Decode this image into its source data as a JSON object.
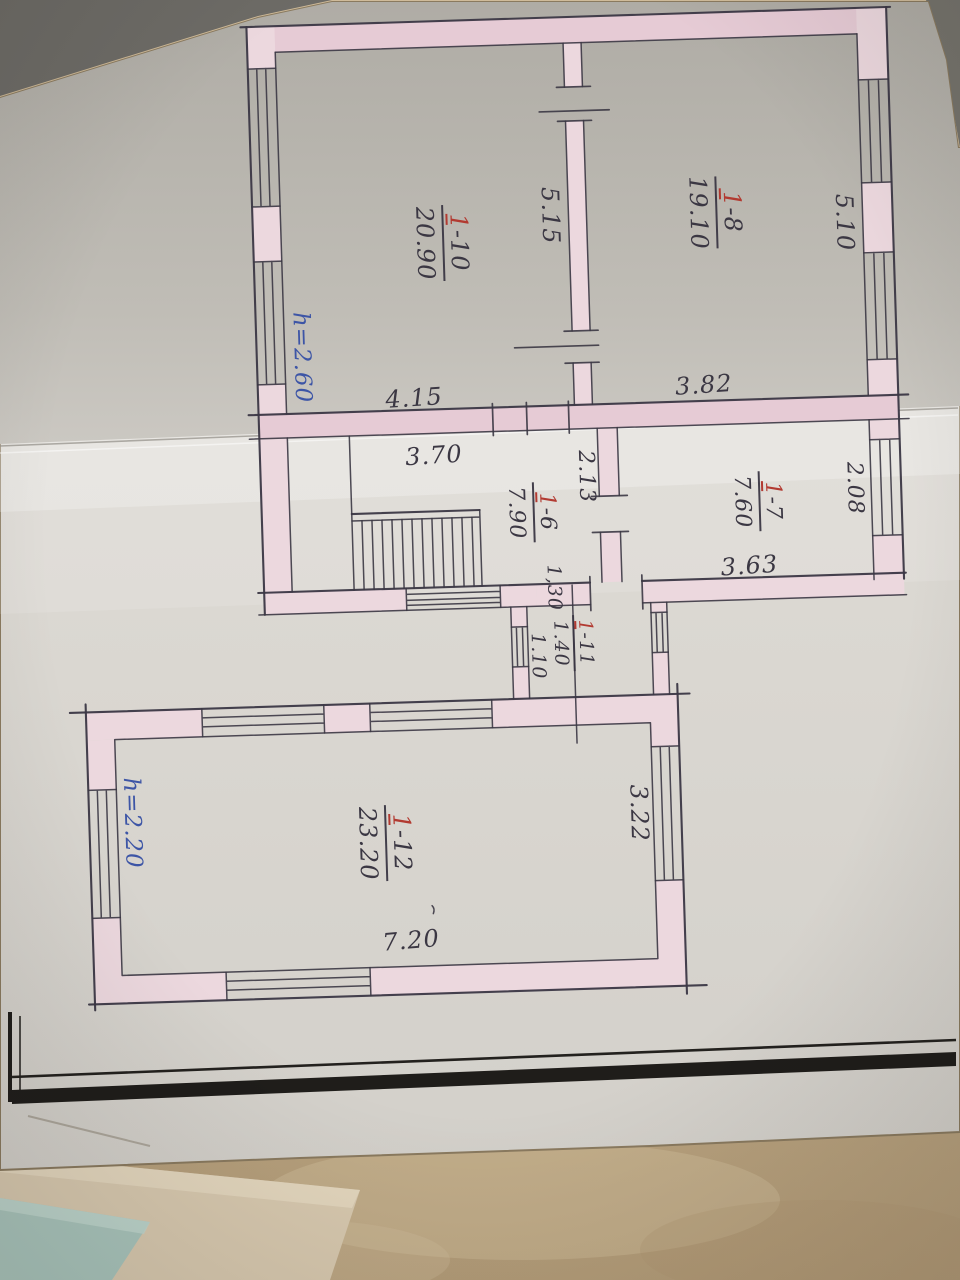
{
  "labels": {
    "rooms": {
      "r110": {
        "red": "1",
        "rest": "-10",
        "area": "20.90"
      },
      "r18": {
        "red": "1",
        "rest": "-8",
        "area": "19.10"
      },
      "r16": {
        "red": "1",
        "rest": "-6",
        "area": "7.90"
      },
      "r17": {
        "red": "1",
        "rest": "-7",
        "area": "7.60"
      },
      "r111": {
        "red": "1",
        "rest": "-11",
        "area": "1.40"
      },
      "r112": {
        "red": "1",
        "rest": "-12",
        "area": "23.20"
      }
    },
    "dims": {
      "room110_depth": "5.15",
      "right_wall_top": "5.10",
      "band_left": "4.15",
      "band_right": "3.82",
      "room16_width": "3.70",
      "room16_depth": "2.13",
      "room17_side": "2.08",
      "room17_width": "3.63",
      "door_130": "1,30",
      "door_110": "1.10",
      "room112_depth": "3.22",
      "room112_width": "7.20"
    },
    "heights": {
      "upper_section": "h=2.60",
      "lower_section": "h=2.20"
    }
  },
  "colors": {
    "ink": "#3b3744",
    "wall_fill": "#ecd8de",
    "wall_fill_strong": "#e6cbd5",
    "room_number_red": "#b23a31",
    "height_note_blue": "#3d55a6",
    "paper_above_fold": "#b6b3ac",
    "paper_below_fold": "#dedbd5",
    "page_frame_black": "#1f1d1a",
    "table_surface": "#c6b08e",
    "teal_object": "#aac6bd"
  }
}
